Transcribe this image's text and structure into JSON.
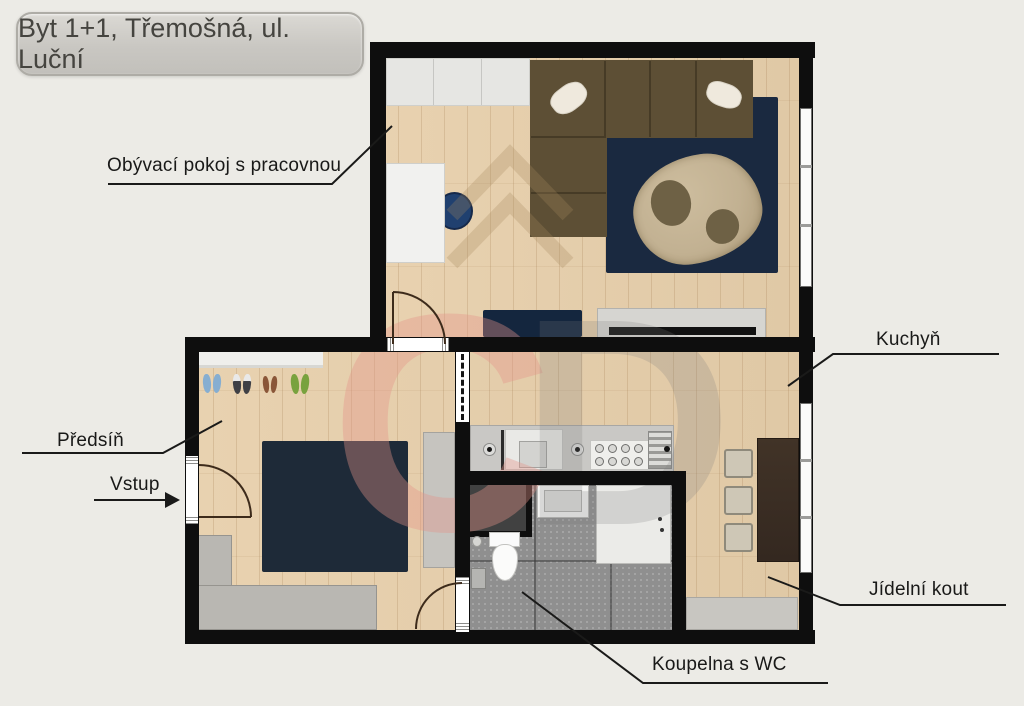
{
  "title": "Byt 1+1, Třemošná, ul. Luční",
  "labels": {
    "living_room": "Obývací pokoj s pracovnou",
    "kitchen": "Kuchyň",
    "hallway": "Předsíň",
    "entrance": "Vstup",
    "dining_nook": "Jídelní kout",
    "bathroom": "Koupelna s WC"
  },
  "watermark": {
    "letter_red": "C",
    "letter_gray": "D"
  },
  "colors": {
    "background": "#ecebe6",
    "wall": "#0e0e0e",
    "wood_floor": "#e7cfab",
    "tile_floor": "#8f8f8f",
    "rug_navy": "#1a2940",
    "sofa_brown": "#5d4f35",
    "coffee_table_beige": "#c2b192",
    "cabinet_gray": "#b9b7b2",
    "dining_table_brown": "#3a2d22",
    "desk_chair_blue": "#20406f",
    "watermark_red": "#e8968a",
    "title_box_gray": "#c9c7c2"
  }
}
